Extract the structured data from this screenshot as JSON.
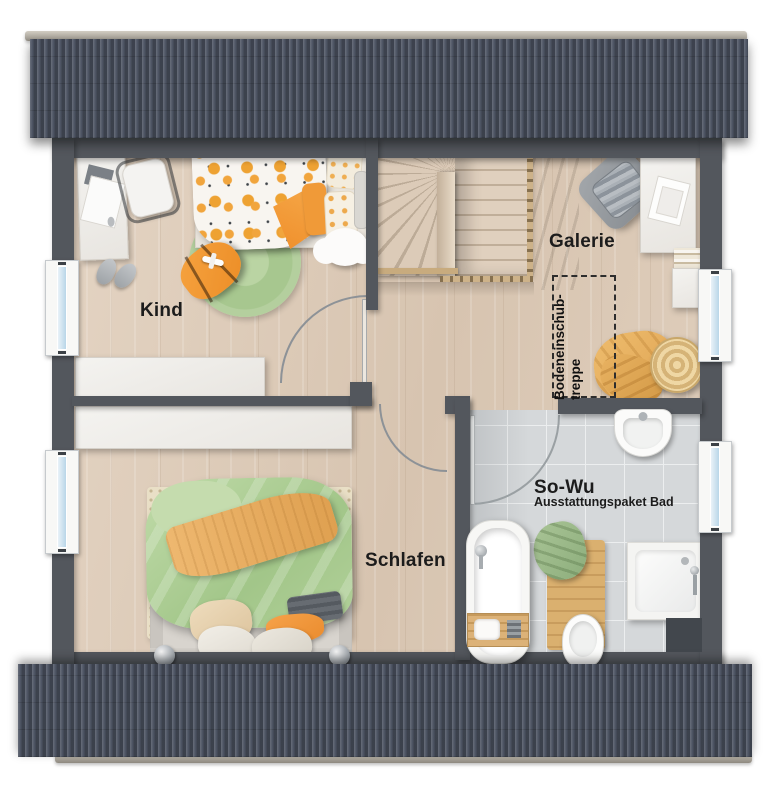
{
  "plan": {
    "rooms": [
      {
        "id": "kind",
        "label": "Kind"
      },
      {
        "id": "galerie",
        "label": "Galerie"
      },
      {
        "id": "schlafen",
        "label": "Schlafen"
      },
      {
        "id": "bad",
        "label": "So-Wu",
        "sublabel": "Ausstattungspaket Bad"
      }
    ],
    "attic_hatch": {
      "line1": "Bodeneinschub-",
      "line2": "treppe"
    },
    "colors": {
      "roof": "#4e5564",
      "ridge_cap": "#aca79d",
      "wall": "#53575d",
      "floor_wood": "#ddccba",
      "bath_tile": "#d5d8da",
      "accent_orange": "#ef8f2b",
      "accent_green": "#a7c78f",
      "duvet_green": "#a2c689",
      "window_glass": "#b9d6e8",
      "furniture_white": "#f4f3f0"
    }
  }
}
